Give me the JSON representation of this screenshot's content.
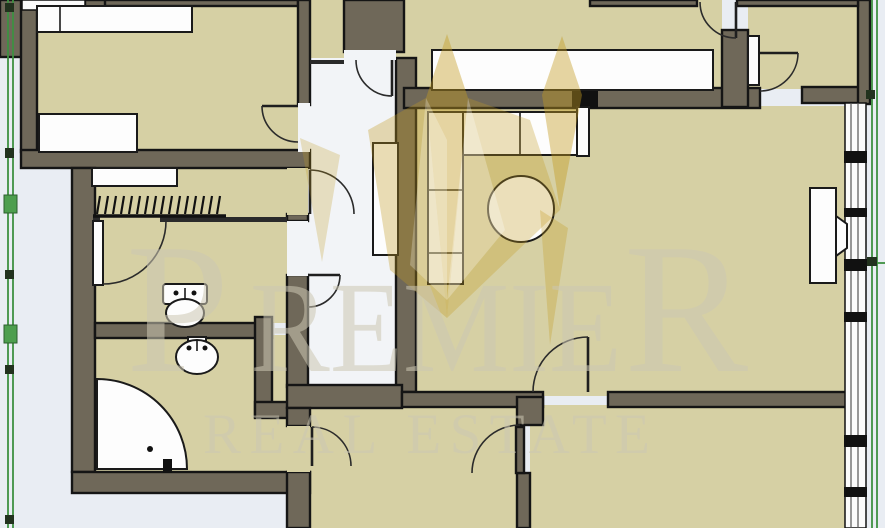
{
  "watermark": {
    "brand": "PREMIER",
    "tagline": "REAL ESTATE",
    "parts": {
      "p": "P",
      "remie": "REMIE",
      "r": "R"
    }
  },
  "colors": {
    "floor": "#d6d0a4",
    "wall": "#6f6859",
    "outline": "#151515",
    "corridor": "#f2f4f7",
    "outside": "#e9edf3",
    "window": "#fbfbfb",
    "green": "#3e9141",
    "gold": "#c39a22",
    "furniture": "#fdfdfd",
    "watermark": "#ccc7b3"
  }
}
